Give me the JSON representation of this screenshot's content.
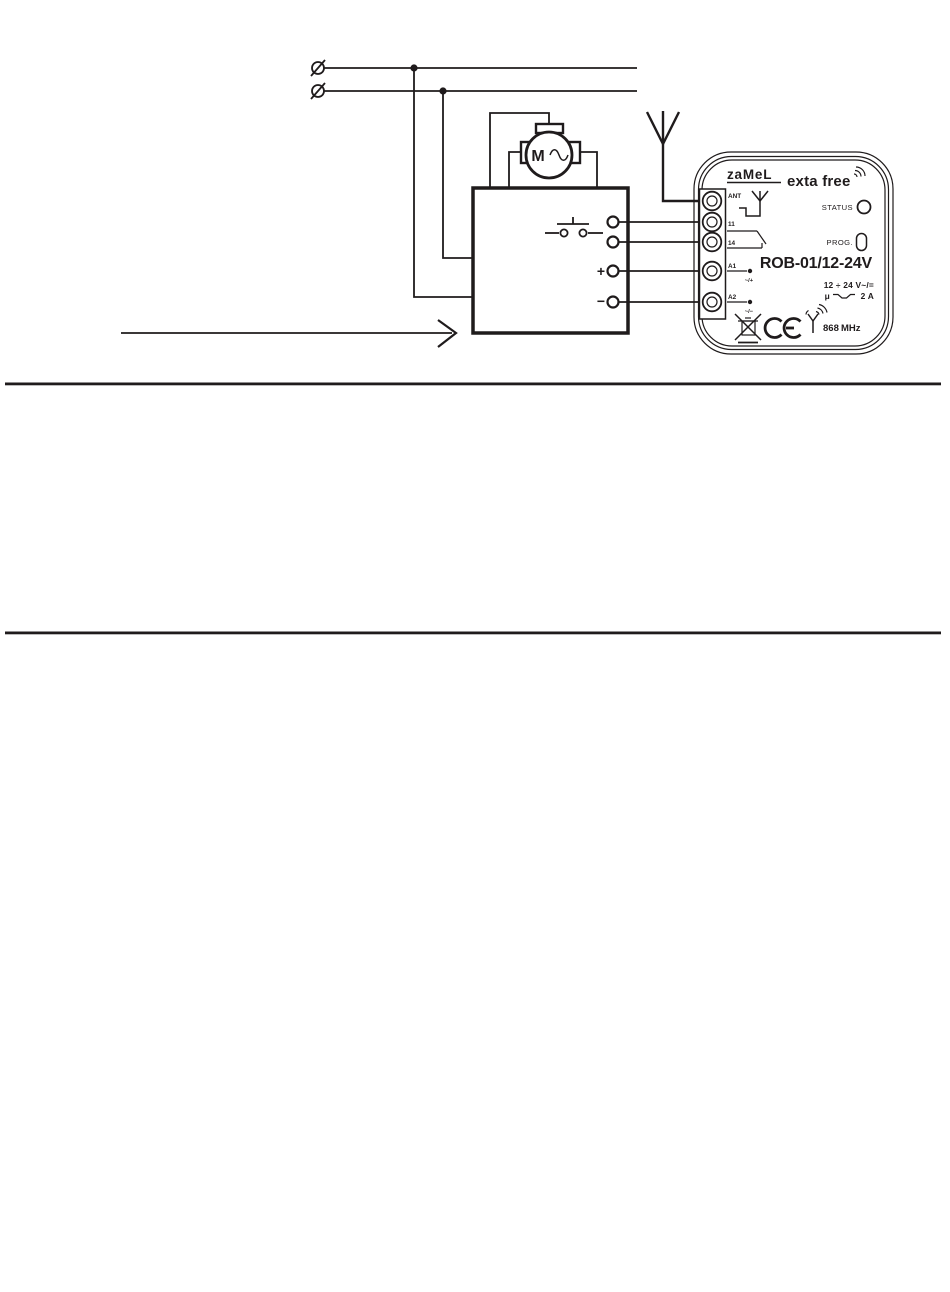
{
  "colors": {
    "ink": "#1f1b1c",
    "paper": "#ffffff"
  },
  "schematic": {
    "motor_label": "M",
    "box_plus": "+",
    "box_minus": "−"
  },
  "device": {
    "brand": "zaMeL",
    "family": "exta free",
    "status_label": "STATUS",
    "prog_label": "PROG.",
    "model": "ROB-01/12-24V",
    "rating_voltage": "12 ÷ 24 V~/=",
    "rating_micro": "μ",
    "rating_current": "2 A",
    "frequency": "868",
    "frequency_unit": "MHz",
    "terminals": [
      {
        "label": "ANT"
      },
      {
        "label": "11"
      },
      {
        "label": "14"
      },
      {
        "label": "A1",
        "polarity": "~/+"
      },
      {
        "label": "A2",
        "polarity": "~/−"
      }
    ]
  }
}
